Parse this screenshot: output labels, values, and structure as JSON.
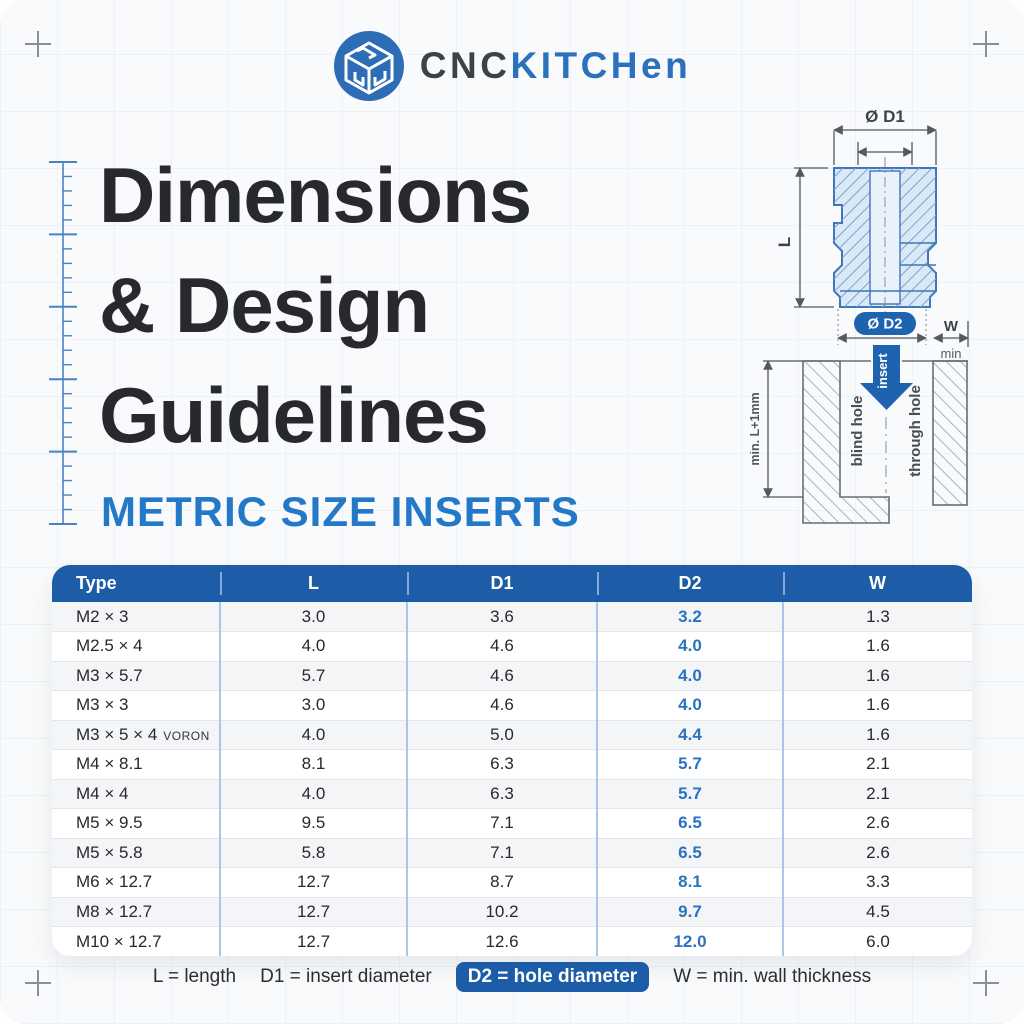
{
  "brand": {
    "name_primary": "CNC",
    "name_secondary": "KITCHen",
    "logo_icon": "cnc-cube-icon",
    "circle_color": "#2d6db5",
    "secondary_color": "#2b72bd"
  },
  "title": {
    "line1": "Dimensions",
    "line2": "& Design",
    "line3": "Guidelines"
  },
  "subtitle": "METRIC SIZE INSERTS",
  "diagram": {
    "labels": {
      "d1": "Ø D1",
      "l": "L",
      "d2": "Ø D2",
      "w": "W",
      "min": "min",
      "insert": "insert",
      "blind_hole": "blind hole",
      "through_hole": "through hole",
      "min_depth": "min. L+1mm"
    }
  },
  "table": {
    "columns": [
      "Type",
      "L",
      "D1",
      "D2",
      "W"
    ],
    "rows": [
      {
        "type": "M2 × 3",
        "suffix": "",
        "l": "3.0",
        "d1": "3.6",
        "d2": "3.2",
        "w": "1.3"
      },
      {
        "type": "M2.5 × 4",
        "suffix": "",
        "l": "4.0",
        "d1": "4.6",
        "d2": "4.0",
        "w": "1.6"
      },
      {
        "type": "M3 × 5.7",
        "suffix": "",
        "l": "5.7",
        "d1": "4.6",
        "d2": "4.0",
        "w": "1.6"
      },
      {
        "type": "M3 × 3",
        "suffix": "",
        "l": "3.0",
        "d1": "4.6",
        "d2": "4.0",
        "w": "1.6"
      },
      {
        "type": "M3 × 5 × 4",
        "suffix": "VORON",
        "l": "4.0",
        "d1": "5.0",
        "d2": "4.4",
        "w": "1.6"
      },
      {
        "type": "M4 × 8.1",
        "suffix": "",
        "l": "8.1",
        "d1": "6.3",
        "d2": "5.7",
        "w": "2.1"
      },
      {
        "type": "M4 × 4",
        "suffix": "",
        "l": "4.0",
        "d1": "6.3",
        "d2": "5.7",
        "w": "2.1"
      },
      {
        "type": "M5 × 9.5",
        "suffix": "",
        "l": "9.5",
        "d1": "7.1",
        "d2": "6.5",
        "w": "2.6"
      },
      {
        "type": "M5 × 5.8",
        "suffix": "",
        "l": "5.8",
        "d1": "7.1",
        "d2": "6.5",
        "w": "2.6"
      },
      {
        "type": "M6 × 12.7",
        "suffix": "",
        "l": "12.7",
        "d1": "8.7",
        "d2": "8.1",
        "w": "3.3"
      },
      {
        "type": "M8 × 12.7",
        "suffix": "",
        "l": "12.7",
        "d1": "10.2",
        "d2": "9.7",
        "w": "4.5"
      },
      {
        "type": "M10 × 12.7",
        "suffix": "",
        "l": "12.7",
        "d1": "12.6",
        "d2": "12.0",
        "w": "6.0"
      }
    ]
  },
  "legend": {
    "items": [
      {
        "label": "L = length",
        "highlighted": false
      },
      {
        "label": "D1 = insert diameter",
        "highlighted": false
      },
      {
        "label": "D2 = hole diameter",
        "highlighted": true
      },
      {
        "label": "W = min. wall thickness",
        "highlighted": false
      }
    ]
  },
  "colors": {
    "accent_blue": "#2478c8",
    "header_blue": "#1d5da7",
    "badge_blue": "#1e63b0",
    "d2_value_blue": "#2b72c0",
    "title_dark": "#27292c",
    "insert_fill": "#dbe8f6",
    "insert_stroke": "#3f76b8",
    "dimension_gray": "#55595e"
  }
}
